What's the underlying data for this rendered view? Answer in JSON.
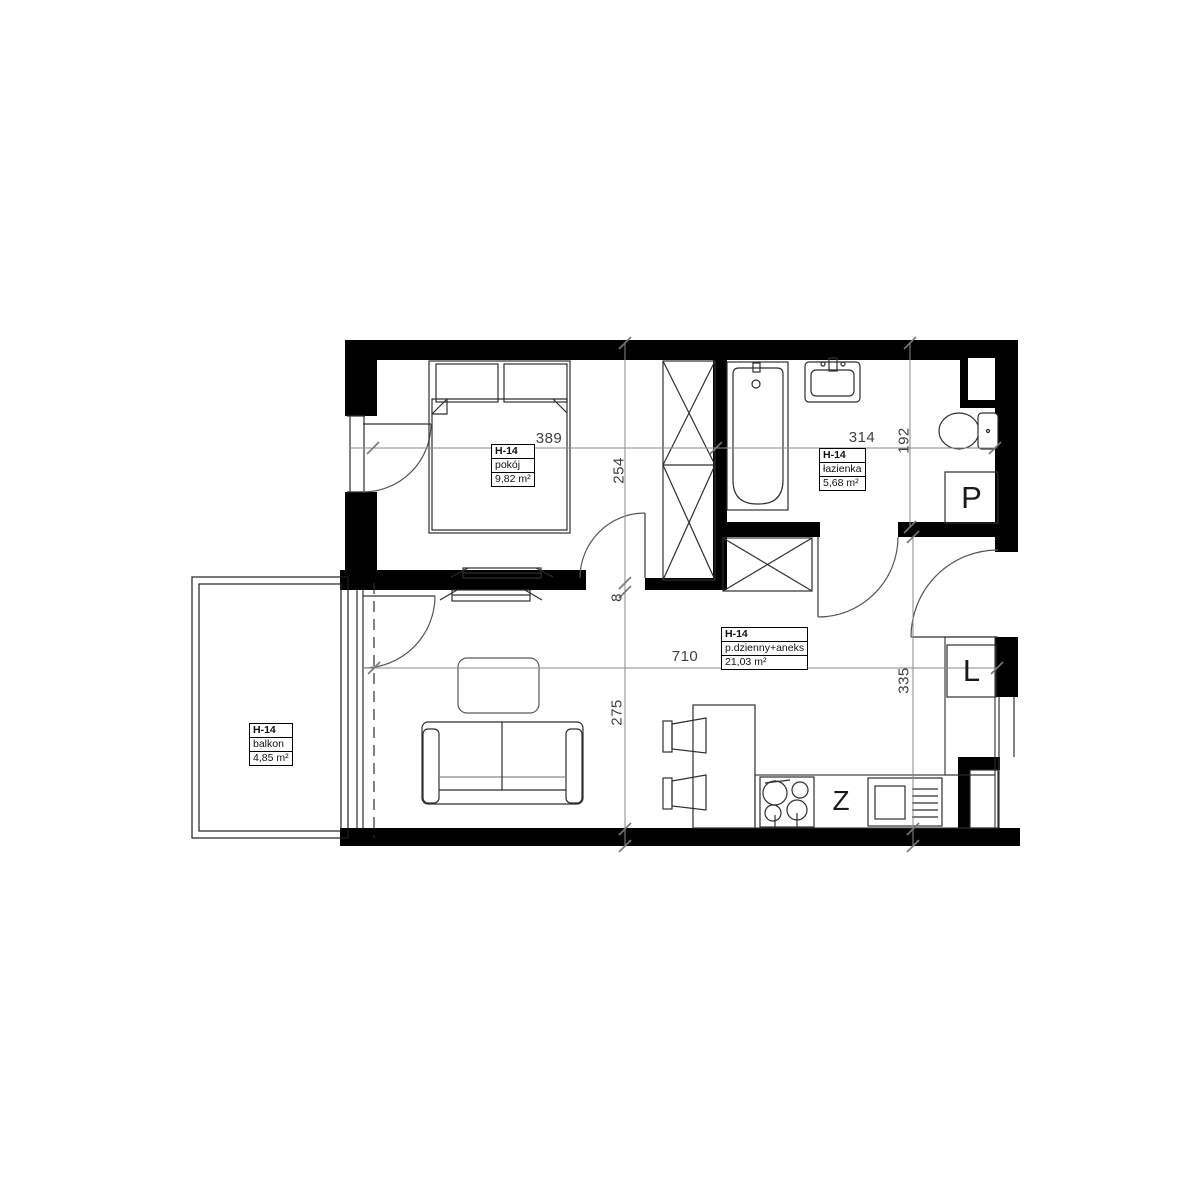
{
  "unit": "H-14",
  "rooms": {
    "bedroom": {
      "id": "H-14",
      "name": "pokój",
      "area": "9,82 m²"
    },
    "bathroom": {
      "id": "H-14",
      "name": "łazienka",
      "area": "5,68 m²"
    },
    "living": {
      "id": "H-14",
      "name": "p.dzienny+aneks",
      "area": "21,03 m²"
    },
    "balcony": {
      "id": "H-14",
      "name": "balkon",
      "area": "4,85 m²"
    }
  },
  "appliances": {
    "washing_machine": "P",
    "fridge": "L",
    "dishwasher": "Z"
  },
  "dimensions_cm": {
    "bedroom_width": "389",
    "bedroom_depth": "254",
    "partition_gap": "8",
    "bathroom_width": "314",
    "bathroom_depth": "192",
    "living_width": "710",
    "living_depth": "275",
    "kitchen_depth": "335"
  },
  "colors": {
    "wall": "#000000",
    "furniture_line": "#2e2e2e",
    "dimension_line": "#8a8a8a",
    "dimension_text": "#3f3f3f"
  }
}
